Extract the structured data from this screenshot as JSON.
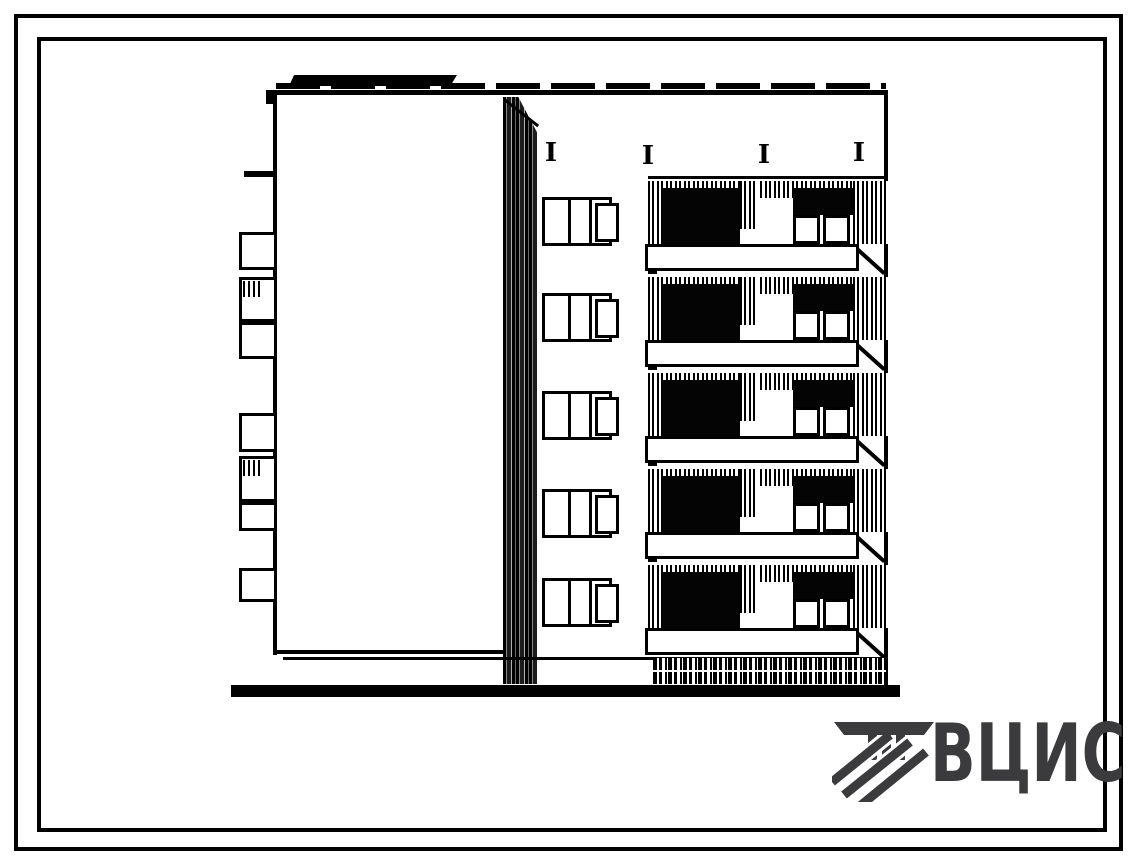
{
  "page": {
    "background": "#ffffff",
    "frame_color": "#000000",
    "ink_color": "#000000"
  },
  "drawing": {
    "subject": "five-storey building end elevation, scanned line drawing",
    "floors": 5,
    "facade_window_count": 5,
    "balcony_module_count": 5,
    "anchor_mark_count": 4,
    "side_balcony_profile_count": 7,
    "anchor_mark_glyph": "I"
  },
  "logo": {
    "text": "ВЦИС",
    "color": "#3b3b3d",
    "icon": "vcis-emblem-icon"
  }
}
